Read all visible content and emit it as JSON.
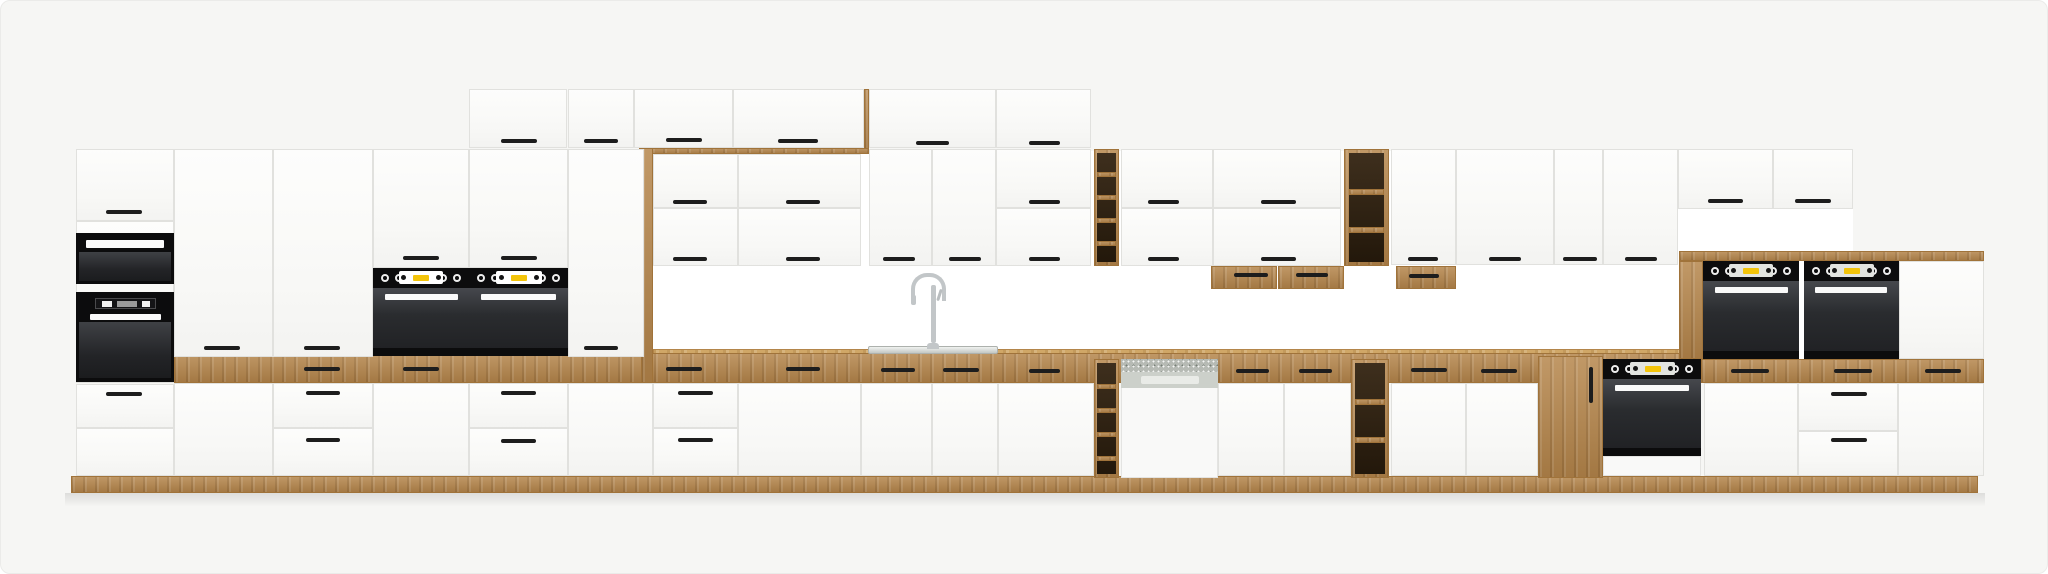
{
  "meta": {
    "subject": "kitchen-cabinet-set-product-render",
    "text_content": "none"
  },
  "palette": {
    "background": "#f6f6f4",
    "backsplash_wall": "#ffffff",
    "cabinet_white": "#fbfbfa",
    "cabinet_line": "#e1e1de",
    "oak_wood": "#b5854a",
    "oak_light": "#d0a767",
    "appliance_black": "#0c0c0d",
    "oven_glass": "#2a2c2f",
    "accent_yellow": "#f3c40a",
    "stainless": "#c3c7c3",
    "handle_dark": "#1d1d1d"
  },
  "canvas": {
    "width": 2048,
    "height": 574
  },
  "scene": {
    "items": [
      {
        "t": "bs",
        "n": "backsplash-wall",
        "x": 652,
        "y": 150,
        "w": 1200,
        "h": 232
      },
      {
        "t": "woodtop",
        "n": "countertop-edge",
        "x": 652,
        "y": 348,
        "w": 1048,
        "h": 5
      },
      {
        "t": "wood",
        "n": "countertop-band",
        "x": 173,
        "y": 352,
        "w": 1527,
        "h": 30
      },
      {
        "t": "wood",
        "n": "canopy-strip",
        "x": 638,
        "y": 147,
        "w": 230,
        "h": 6
      },
      {
        "t": "wood",
        "n": "frame-leg-left",
        "x": 640,
        "y": 147,
        "w": 12,
        "h": 235
      },
      {
        "t": "wood",
        "n": "toprow-side-panel",
        "x": 863,
        "y": 88,
        "w": 5,
        "h": 60
      },
      {
        "t": "wood",
        "n": "elevated-counter-slab",
        "x": 1678,
        "y": 250,
        "w": 305,
        "h": 10
      },
      {
        "t": "wood",
        "n": "elevated-counter-band",
        "x": 1700,
        "y": 358,
        "w": 283,
        "h": 24
      },
      {
        "t": "wood",
        "n": "plinth",
        "x": 70,
        "y": 475,
        "w": 1907,
        "h": 17
      },
      {
        "t": "shadow",
        "n": "floor-shadow",
        "x": 64,
        "y": 492,
        "w": 1920,
        "h": 14
      },
      {
        "t": "door",
        "n": "top-cabinet-door",
        "x": 468,
        "y": 88,
        "w": 98,
        "h": 59
      },
      {
        "t": "door",
        "n": "top-cabinet-door",
        "x": 567,
        "y": 88,
        "w": 66,
        "h": 59
      },
      {
        "t": "door",
        "n": "top-cabinet-door",
        "x": 633,
        "y": 88,
        "w": 99,
        "h": 59
      },
      {
        "t": "door",
        "n": "top-cabinet-door",
        "x": 732,
        "y": 88,
        "w": 131,
        "h": 59
      },
      {
        "t": "door",
        "n": "top-cabinet-door",
        "x": 868,
        "y": 88,
        "w": 127,
        "h": 59
      },
      {
        "t": "door",
        "n": "top-cabinet-door",
        "x": 995,
        "y": 88,
        "w": 95,
        "h": 59
      },
      {
        "t": "door",
        "n": "tall-unit-face",
        "x": 75,
        "y": 220,
        "w": 98,
        "h": 162
      },
      {
        "t": "door",
        "n": "tall-unit-top-door",
        "x": 75,
        "y": 148,
        "w": 98,
        "h": 72
      },
      {
        "t": "mw",
        "n": "built-in-microwave",
        "x": 75,
        "y": 232,
        "w": 98,
        "h": 51
      },
      {
        "t": "two",
        "n": "built-in-oven-tower",
        "x": 75,
        "y": 291,
        "w": 98,
        "h": 90
      },
      {
        "t": "door",
        "n": "base-drawer",
        "x": 75,
        "y": 383,
        "w": 98,
        "h": 44
      },
      {
        "t": "door",
        "n": "base-door",
        "x": 75,
        "y": 427,
        "w": 98,
        "h": 48
      },
      {
        "t": "door",
        "n": "tall-pantry-door",
        "x": 173,
        "y": 148,
        "w": 99,
        "h": 208
      },
      {
        "t": "door",
        "n": "tall-pantry-door",
        "x": 272,
        "y": 148,
        "w": 100,
        "h": 208
      },
      {
        "t": "door",
        "n": "oven-tower-upper-door",
        "x": 372,
        "y": 148,
        "w": 96,
        "h": 119
      },
      {
        "t": "door",
        "n": "oven-tower-upper-door",
        "x": 468,
        "y": 148,
        "w": 99,
        "h": 119
      },
      {
        "t": "oven",
        "n": "built-in-oven",
        "x": 372,
        "y": 267,
        "w": 96,
        "h": 88,
        "v": "w"
      },
      {
        "t": "oven",
        "n": "built-in-oven",
        "x": 468,
        "y": 267,
        "w": 99,
        "h": 88,
        "v": "w"
      },
      {
        "t": "door",
        "n": "tall-pantry-door",
        "x": 567,
        "y": 148,
        "w": 76,
        "h": 208
      },
      {
        "t": "door",
        "n": "wall-cabinet-door",
        "x": 652,
        "y": 153,
        "w": 85,
        "h": 54
      },
      {
        "t": "door",
        "n": "wall-cabinet-door",
        "x": 652,
        "y": 207,
        "w": 85,
        "h": 58
      },
      {
        "t": "door",
        "n": "wall-cabinet-door",
        "x": 737,
        "y": 153,
        "w": 123,
        "h": 54
      },
      {
        "t": "door",
        "n": "wall-cabinet-door",
        "x": 737,
        "y": 207,
        "w": 123,
        "h": 58
      },
      {
        "t": "door",
        "n": "wall-cabinet-door",
        "x": 868,
        "y": 148,
        "w": 63,
        "h": 117
      },
      {
        "t": "door",
        "n": "wall-cabinet-door",
        "x": 931,
        "y": 148,
        "w": 64,
        "h": 117
      },
      {
        "t": "door",
        "n": "wall-cabinet-door",
        "x": 995,
        "y": 148,
        "w": 95,
        "h": 59
      },
      {
        "t": "door",
        "n": "wall-cabinet-door",
        "x": 995,
        "y": 207,
        "w": 95,
        "h": 58
      },
      {
        "t": "door",
        "n": "wall-cabinet-door",
        "x": 1120,
        "y": 148,
        "w": 92,
        "h": 59
      },
      {
        "t": "door",
        "n": "wall-cabinet-door",
        "x": 1120,
        "y": 207,
        "w": 92,
        "h": 58
      },
      {
        "t": "door",
        "n": "wall-cabinet-door",
        "x": 1212,
        "y": 148,
        "w": 128,
        "h": 59
      },
      {
        "t": "door",
        "n": "wall-cabinet-door",
        "x": 1212,
        "y": 207,
        "w": 128,
        "h": 58
      },
      {
        "t": "door",
        "n": "wall-cabinet-door",
        "x": 1390,
        "y": 148,
        "w": 65,
        "h": 116
      },
      {
        "t": "door",
        "n": "wall-cabinet-door",
        "x": 1455,
        "y": 148,
        "w": 98,
        "h": 116
      },
      {
        "t": "door",
        "n": "wall-cabinet-door",
        "x": 1553,
        "y": 148,
        "w": 49,
        "h": 116
      },
      {
        "t": "door",
        "n": "wall-cabinet-door",
        "x": 1602,
        "y": 148,
        "w": 75,
        "h": 116
      },
      {
        "t": "door",
        "n": "wall-cabinet-door",
        "x": 1677,
        "y": 148,
        "w": 95,
        "h": 60
      },
      {
        "t": "door",
        "n": "wall-cabinet-door",
        "x": 1772,
        "y": 148,
        "w": 80,
        "h": 60
      },
      {
        "t": "wood",
        "n": "open-shelf-unit",
        "x": 1093,
        "y": 148,
        "w": 25,
        "h": 117
      },
      {
        "t": "wd",
        "n": "shelf-opening",
        "x": 1096,
        "y": 152,
        "w": 19,
        "h": 109
      },
      {
        "t": "wood",
        "n": "shelf-board",
        "x": 1096,
        "y": 171,
        "w": 19,
        "h": 5
      },
      {
        "t": "wood",
        "n": "shelf-board",
        "x": 1096,
        "y": 194,
        "w": 19,
        "h": 5
      },
      {
        "t": "wood",
        "n": "shelf-board",
        "x": 1096,
        "y": 217,
        "w": 19,
        "h": 5
      },
      {
        "t": "wood",
        "n": "shelf-board",
        "x": 1096,
        "y": 240,
        "w": 19,
        "h": 5
      },
      {
        "t": "wood",
        "n": "open-shelf-unit",
        "x": 1093,
        "y": 358,
        "w": 25,
        "h": 119
      },
      {
        "t": "wd",
        "n": "shelf-opening",
        "x": 1096,
        "y": 362,
        "w": 19,
        "h": 111
      },
      {
        "t": "wood",
        "n": "shelf-board",
        "x": 1096,
        "y": 383,
        "w": 19,
        "h": 5
      },
      {
        "t": "wood",
        "n": "shelf-board",
        "x": 1096,
        "y": 407,
        "w": 19,
        "h": 5
      },
      {
        "t": "wood",
        "n": "shelf-board",
        "x": 1096,
        "y": 431,
        "w": 19,
        "h": 5
      },
      {
        "t": "wood",
        "n": "shelf-board",
        "x": 1096,
        "y": 455,
        "w": 19,
        "h": 5
      },
      {
        "t": "wood",
        "n": "open-shelf-unit",
        "x": 1343,
        "y": 148,
        "w": 45,
        "h": 117
      },
      {
        "t": "wd",
        "n": "shelf-opening",
        "x": 1348,
        "y": 152,
        "w": 35,
        "h": 109
      },
      {
        "t": "wood",
        "n": "shelf-board",
        "x": 1348,
        "y": 188,
        "w": 35,
        "h": 6
      },
      {
        "t": "wood",
        "n": "shelf-board",
        "x": 1348,
        "y": 226,
        "w": 35,
        "h": 6
      },
      {
        "t": "wood",
        "n": "open-shelf-unit",
        "x": 1350,
        "y": 358,
        "w": 38,
        "h": 119
      },
      {
        "t": "wd",
        "n": "shelf-opening",
        "x": 1354,
        "y": 362,
        "w": 30,
        "h": 111
      },
      {
        "t": "wood",
        "n": "shelf-board",
        "x": 1354,
        "y": 398,
        "w": 30,
        "h": 6
      },
      {
        "t": "wood",
        "n": "shelf-board",
        "x": 1354,
        "y": 436,
        "w": 30,
        "h": 6
      },
      {
        "t": "wood",
        "n": "under-cabinet-wood-drawer",
        "x": 1210,
        "y": 265,
        "w": 66,
        "h": 23
      },
      {
        "t": "wood",
        "n": "under-cabinet-wood-drawer",
        "x": 1277,
        "y": 265,
        "w": 66,
        "h": 23
      },
      {
        "t": "wood",
        "n": "under-cabinet-wood-drawer",
        "x": 1395,
        "y": 265,
        "w": 60,
        "h": 23
      },
      {
        "t": "wood",
        "n": "wood-base-door",
        "x": 1537,
        "y": 355,
        "w": 65,
        "h": 122
      },
      {
        "t": "dw",
        "n": "built-in-dishwasher",
        "x": 1120,
        "y": 358,
        "w": 97,
        "h": 119
      },
      {
        "t": "oven",
        "n": "built-in-oven",
        "x": 1602,
        "y": 358,
        "w": 98,
        "h": 117,
        "v": "u"
      },
      {
        "t": "wood",
        "n": "oven-unit-side-panel",
        "x": 1678,
        "y": 260,
        "w": 24,
        "h": 98
      },
      {
        "t": "oven",
        "n": "built-in-oven",
        "x": 1702,
        "y": 260,
        "w": 96,
        "h": 98,
        "v": "s"
      },
      {
        "t": "oven",
        "n": "built-in-oven",
        "x": 1803,
        "y": 260,
        "w": 95,
        "h": 98,
        "v": "s"
      },
      {
        "t": "door",
        "n": "appliance-panel-door",
        "x": 1898,
        "y": 260,
        "w": 85,
        "h": 98
      },
      {
        "t": "door",
        "n": "base-door",
        "x": 173,
        "y": 382,
        "w": 99,
        "h": 93
      },
      {
        "t": "door",
        "n": "base-drawer",
        "x": 272,
        "y": 382,
        "w": 100,
        "h": 45
      },
      {
        "t": "door",
        "n": "base-drawer",
        "x": 272,
        "y": 427,
        "w": 100,
        "h": 48
      },
      {
        "t": "door",
        "n": "base-door",
        "x": 372,
        "y": 382,
        "w": 96,
        "h": 93
      },
      {
        "t": "door",
        "n": "base-drawer",
        "x": 468,
        "y": 382,
        "w": 99,
        "h": 45
      },
      {
        "t": "door",
        "n": "base-drawer",
        "x": 468,
        "y": 427,
        "w": 99,
        "h": 48
      },
      {
        "t": "door",
        "n": "base-door",
        "x": 567,
        "y": 382,
        "w": 85,
        "h": 93
      },
      {
        "t": "door",
        "n": "base-drawer",
        "x": 652,
        "y": 382,
        "w": 85,
        "h": 45
      },
      {
        "t": "door",
        "n": "base-drawer",
        "x": 652,
        "y": 427,
        "w": 85,
        "h": 48
      },
      {
        "t": "door",
        "n": "base-door",
        "x": 737,
        "y": 382,
        "w": 123,
        "h": 93
      },
      {
        "t": "door",
        "n": "sink-base-door",
        "x": 860,
        "y": 382,
        "w": 71,
        "h": 93
      },
      {
        "t": "door",
        "n": "sink-base-door",
        "x": 931,
        "y": 382,
        "w": 66,
        "h": 93
      },
      {
        "t": "door",
        "n": "base-door",
        "x": 997,
        "y": 382,
        "w": 96,
        "h": 93
      },
      {
        "t": "door",
        "n": "base-door",
        "x": 1217,
        "y": 382,
        "w": 66,
        "h": 93
      },
      {
        "t": "door",
        "n": "base-door",
        "x": 1283,
        "y": 382,
        "w": 67,
        "h": 93
      },
      {
        "t": "door",
        "n": "base-door",
        "x": 1390,
        "y": 382,
        "w": 75,
        "h": 93
      },
      {
        "t": "door",
        "n": "base-door",
        "x": 1465,
        "y": 382,
        "w": 72,
        "h": 93
      },
      {
        "t": "door",
        "n": "base-door",
        "x": 1703,
        "y": 382,
        "w": 94,
        "h": 93
      },
      {
        "t": "door",
        "n": "base-drawer",
        "x": 1797,
        "y": 382,
        "w": 100,
        "h": 48
      },
      {
        "t": "door",
        "n": "base-drawer",
        "x": 1797,
        "y": 430,
        "w": 100,
        "h": 45
      },
      {
        "t": "door",
        "n": "base-door",
        "x": 1897,
        "y": 382,
        "w": 86,
        "h": 93
      },
      {
        "t": "sink",
        "n": "sink-basin-rim",
        "x": 867,
        "y": 345,
        "w": 130,
        "h": 8
      },
      {
        "t": "fct",
        "n": "kitchen-faucet",
        "x": 904,
        "y": 272,
        "w": 44,
        "h": 76
      }
    ],
    "handles": [
      [
        500,
        138,
        36
      ],
      [
        583,
        138,
        34
      ],
      [
        665,
        137,
        36
      ],
      [
        777,
        138,
        40
      ],
      [
        915,
        140,
        33
      ],
      [
        1028,
        140,
        31
      ],
      [
        105,
        209,
        36
      ],
      [
        105,
        391,
        36
      ],
      [
        203,
        345,
        36
      ],
      [
        303,
        345,
        36
      ],
      [
        583,
        345,
        34
      ],
      [
        402,
        255,
        36
      ],
      [
        500,
        255,
        36
      ],
      [
        672,
        199,
        34
      ],
      [
        785,
        199,
        34
      ],
      [
        1028,
        199,
        31
      ],
      [
        1147,
        199,
        31
      ],
      [
        1260,
        199,
        35
      ],
      [
        1707,
        198,
        35
      ],
      [
        1794,
        198,
        36
      ],
      [
        672,
        256,
        34
      ],
      [
        785,
        256,
        34
      ],
      [
        882,
        256,
        32
      ],
      [
        948,
        256,
        32
      ],
      [
        1028,
        256,
        31
      ],
      [
        1147,
        256,
        31
      ],
      [
        1260,
        256,
        35
      ],
      [
        1407,
        256,
        30
      ],
      [
        1488,
        256,
        32
      ],
      [
        1562,
        256,
        34
      ],
      [
        1624,
        256,
        32
      ],
      [
        303,
        366,
        36
      ],
      [
        402,
        366,
        36
      ],
      [
        665,
        366,
        36
      ],
      [
        785,
        366,
        34
      ],
      [
        880,
        367,
        34
      ],
      [
        942,
        367,
        36
      ],
      [
        1028,
        368,
        31
      ],
      [
        1235,
        368,
        33
      ],
      [
        1298,
        368,
        33
      ],
      [
        1410,
        367,
        36
      ],
      [
        1480,
        368,
        36
      ],
      [
        1730,
        368,
        38
      ],
      [
        1833,
        368,
        38
      ],
      [
        1924,
        368,
        36
      ],
      [
        1233,
        272,
        34
      ],
      [
        1295,
        272,
        32
      ],
      [
        1408,
        273,
        30
      ],
      [
        1588,
        366,
        4,
        36
      ],
      [
        305,
        390,
        34
      ],
      [
        305,
        437,
        34
      ],
      [
        500,
        390,
        35
      ],
      [
        500,
        438,
        35
      ],
      [
        677,
        390,
        35
      ],
      [
        677,
        437,
        35
      ],
      [
        1830,
        391,
        36
      ],
      [
        1830,
        437,
        36
      ]
    ]
  }
}
